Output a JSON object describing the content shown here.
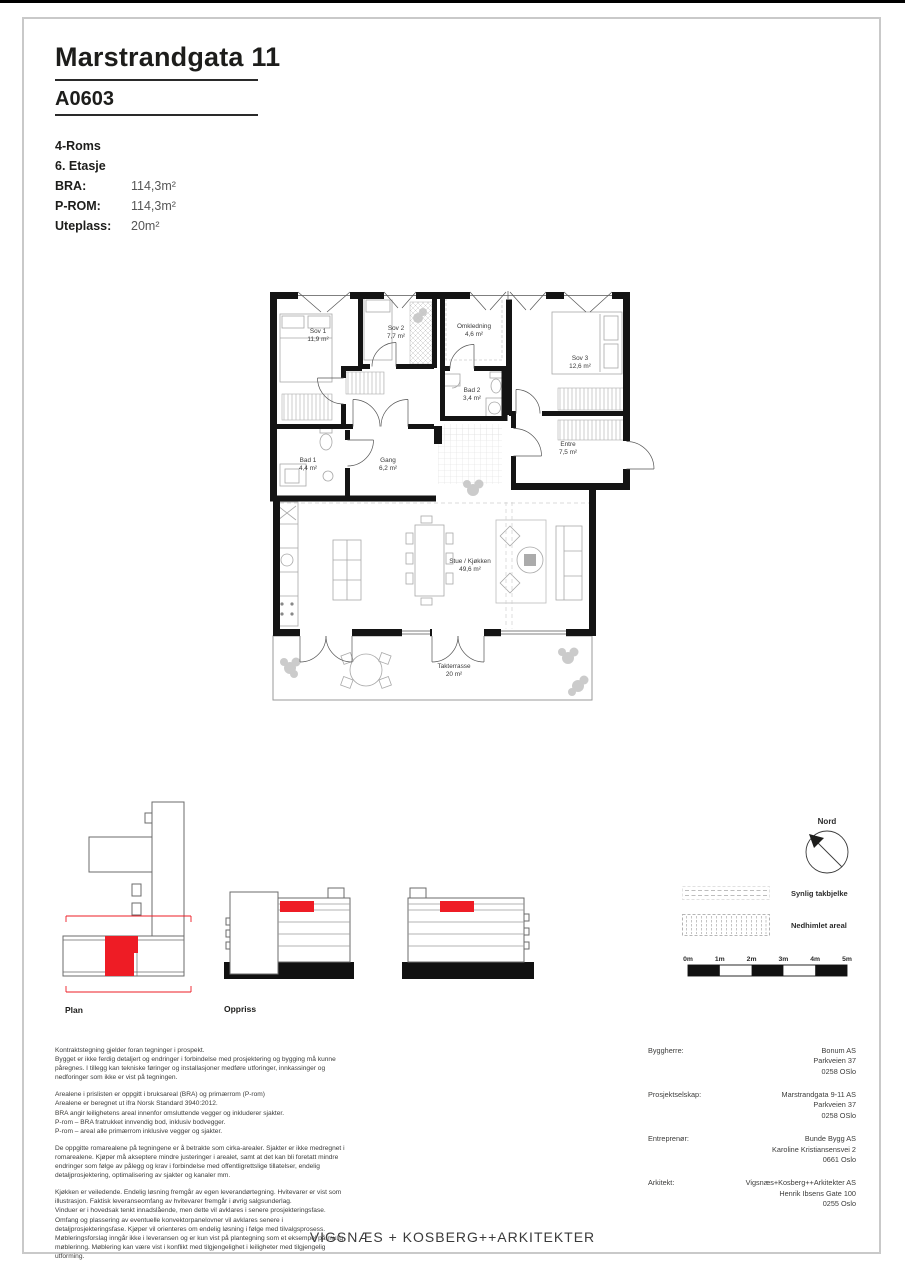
{
  "header": {
    "title": "Marstrandgata 11",
    "unit": "A0603"
  },
  "facts": {
    "rooms": "4-Roms",
    "floor": "6. Etasje",
    "bra_label": "BRA:",
    "bra_value": "114,3m²",
    "prom_label": "P-ROM:",
    "prom_value": "114,3m²",
    "uteplass_label": "Uteplass:",
    "uteplass_value": "20m²"
  },
  "plan": {
    "rooms": [
      {
        "name": "Sov 1",
        "area": "11,9 m²"
      },
      {
        "name": "Sov 2",
        "area": "7,7 m²"
      },
      {
        "name": "Omkledning",
        "area": "4,6 m²"
      },
      {
        "name": "Sov 3",
        "area": "12,6 m²"
      },
      {
        "name": "Bad 2",
        "area": "3,4 m²"
      },
      {
        "name": "Entre",
        "area": "7,5 m²"
      },
      {
        "name": "Bad 1",
        "area": "4,4 m²"
      },
      {
        "name": "Gang",
        "area": "6,2 m²"
      },
      {
        "name": "Stue / Kjøkken",
        "area": "49,6 m²"
      },
      {
        "name": "Takterrasse",
        "area": "20 m²"
      }
    ]
  },
  "keyplans": {
    "plan_label": "Plan",
    "oppriss_label": "Oppriss"
  },
  "legend": {
    "north_label": "Nord",
    "items": [
      {
        "label": "Synlig takbjelke"
      },
      {
        "label": "Nedhimlet areal"
      }
    ],
    "scale_labels": [
      "0m",
      "1m",
      "2m",
      "3m",
      "4m",
      "5m"
    ]
  },
  "disclaimers": [
    "Kontraktstegning gjelder foran tegninger i prospekt.\nBygget er ikke ferdig detaljert og endringer i forbindelse med prosjektering og bygging må kunne\npåregnes. I tillegg kan tekniske føringer og installasjoner medføre utforinger, innkassinger og\nnedforinger som ikke er vist på tegningen.",
    "Arealene i prislisten er oppgitt i bruksareal (BRA) og primærrom (P-rom)\nArealene er beregnet ut ifra Norsk Standard 3940:2012.\nBRA angir leilighetens areal innenfor omsluttende vegger og inkluderer sjakter.\nP-rom – BRA fratrukket innvendig bod, inklusiv bodvegger.\nP-rom – areal alle primærrom inklusive vegger og sjakter.",
    "De oppgitte romarealene på tegningene er å betrakte som cirka-arealer. Sjakter er ikke medregnet i\nromarealene. Kjøper må akseptere mindre justeringer i arealet, samt at det kan bli foretatt mindre\nendringer som følge av pålegg og krav i forbindelse med offentligrettslige tillatelser, endelig\ndetaljprosjektering, optimalisering av sjakter og kanaler mm.",
    "Kjøkken er veiledende. Endelig løsning fremgår av egen leverandørtegning. Hvitevarer er vist som\nillustrasjon. Faktisk leveranseomfang av hvitevarer fremgår i øvrig salgsunderlag.\nVinduer er i hovedsak tenkt innadslående, men dette vil avklares i senere prosjekteringsfase.\nOmfang og plassering av eventuelle konvektorpanelovner vil avklares senere i\ndetaljprosjekteringsfase. Kjøper vil orienteres om endelig løsning i følge med tilvalgsprosess.\nMøbleringsforslag inngår ikke i leveransen og er kun vist på plantegning som et eksempel på mulig\nmøblerinng. Møblering kan være vist i konflikt med tilgjengelighet i leiligheter med tilgjengelig\nutforming."
  ],
  "contacts": [
    {
      "label": "Byggherre:",
      "value": "Bonum AS\nParkveien 37\n0258 OSlo"
    },
    {
      "label": "Prosjektselskap:",
      "value": "Marstrandgata 9-11 AS\nParkveien 37\n0258 OSlo"
    },
    {
      "label": "Entreprenør:",
      "value": "Bunde Bygg AS\nKaroline Kristiansensvei 2\n0661 Oslo"
    },
    {
      "label": "Arkitekt:",
      "value": "Vigsnæs+Kosberg++Arkitekter AS\nHenrik Ibsens Gate 100\n0255 Oslo"
    }
  ],
  "footer": {
    "architect": "VIGSNÆS + KOSBERG++ARKITEKTER"
  },
  "colors": {
    "accent_red": "#ee1c25",
    "wall_black": "#141414",
    "frame_gray": "#c9c9c9"
  }
}
